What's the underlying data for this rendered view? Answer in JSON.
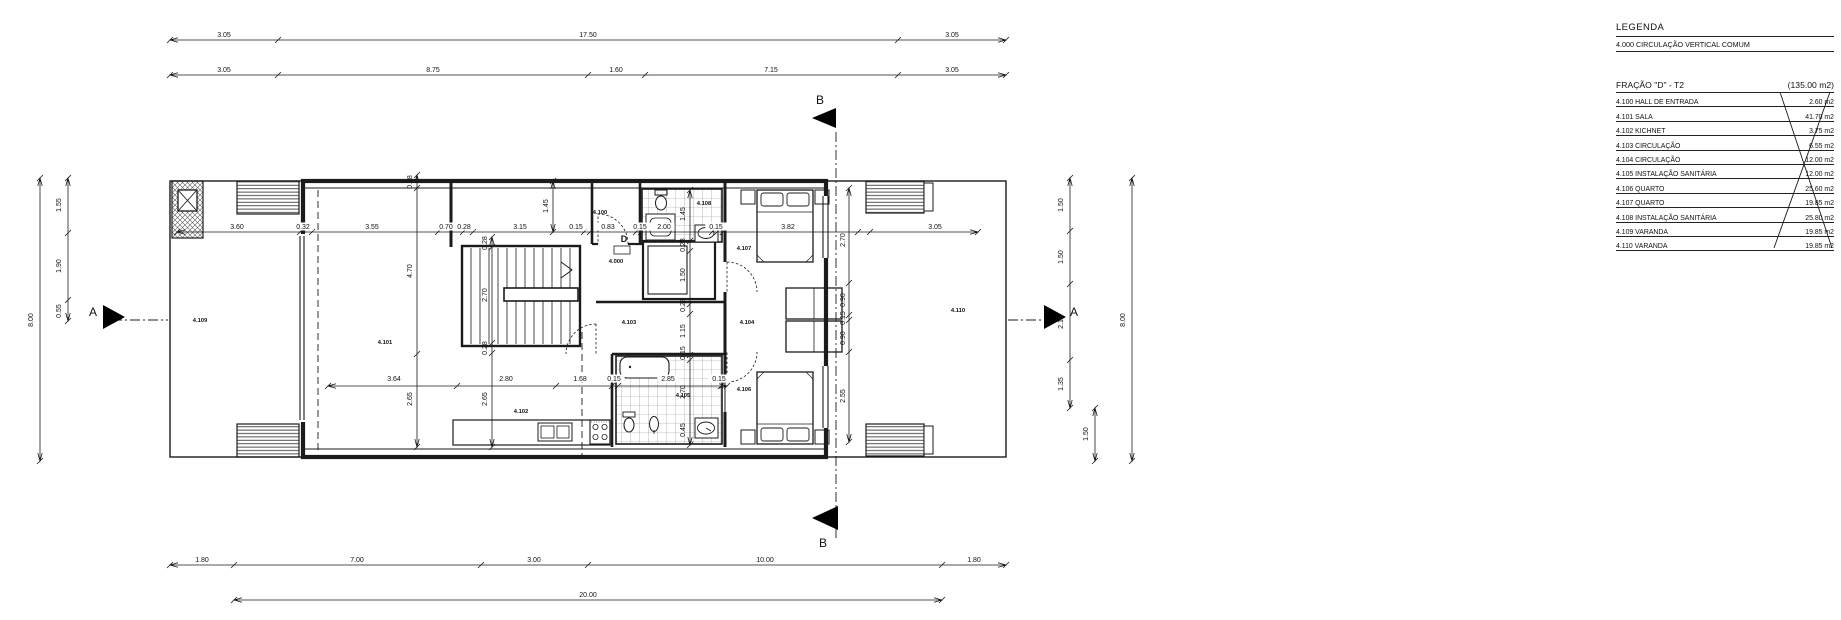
{
  "legend": {
    "title": "LEGENDA",
    "common_item": "4.000 CIRCULAÇÃO VERTICAL COMUM"
  },
  "fraction": {
    "title": "FRAÇÃO \"D\" - T2",
    "total_area": "(135.00 m2)",
    "rows": [
      {
        "code": "4.100",
        "name": "HALL DE ENTRADA",
        "area": "2.60 m2"
      },
      {
        "code": "4.101",
        "name": "SALA",
        "area": "41.70 m2"
      },
      {
        "code": "4.102",
        "name": "KICHNET",
        "area": "3.75 m2"
      },
      {
        "code": "4.103",
        "name": "CIRCULAÇÃO",
        "area": "6.55 m2"
      },
      {
        "code": "4.104",
        "name": "CIRCULAÇÃO",
        "area": "12.00 m2"
      },
      {
        "code": "4.105",
        "name": "INSTALAÇÃO SANITÁRIA",
        "area": "12.00 m2"
      },
      {
        "code": "4.106",
        "name": "QUARTO",
        "area": "25.60 m2"
      },
      {
        "code": "4.107",
        "name": "QUARTO",
        "area": "19.85 m2"
      },
      {
        "code": "4.108",
        "name": "INSTALAÇÃO SANITÁRIA",
        "area": "25.80 m2"
      },
      {
        "code": "4.109",
        "name": "VARANDA",
        "area": "19.85 m2"
      },
      {
        "code": "4.110",
        "name": "VARANDA",
        "area": "19.85 m2"
      }
    ],
    "crossed_out": true
  },
  "plan": {
    "line_color": "#1b1b1b",
    "annotations": [
      {
        "t": "3.05",
        "x": 224,
        "y": 37,
        "k": "d"
      },
      {
        "t": "17.50",
        "x": 588,
        "y": 37,
        "k": "d"
      },
      {
        "t": "3.05",
        "x": 952,
        "y": 37,
        "k": "d"
      },
      {
        "t": "3.05",
        "x": 224,
        "y": 72,
        "k": "d"
      },
      {
        "t": "8.75",
        "x": 433,
        "y": 72,
        "k": "d"
      },
      {
        "t": "1.60",
        "x": 616,
        "y": 72,
        "k": "d"
      },
      {
        "t": "7.15",
        "x": 771,
        "y": 72,
        "k": "d"
      },
      {
        "t": "3.05",
        "x": 952,
        "y": 72,
        "k": "d"
      },
      {
        "t": "1.80",
        "x": 202,
        "y": 562,
        "k": "d"
      },
      {
        "t": "7.00",
        "x": 357,
        "y": 562,
        "k": "d"
      },
      {
        "t": "3.00",
        "x": 534,
        "y": 562,
        "k": "d"
      },
      {
        "t": "10.00",
        "x": 765,
        "y": 562,
        "k": "d"
      },
      {
        "t": "1.80",
        "x": 974,
        "y": 562,
        "k": "d"
      },
      {
        "t": "20.00",
        "x": 588,
        "y": 597,
        "k": "d"
      },
      {
        "t": "8.00",
        "x": 33,
        "y": 320,
        "r": -90,
        "k": "d"
      },
      {
        "t": "1.55",
        "x": 61,
        "y": 205,
        "r": -90,
        "k": "d"
      },
      {
        "t": "1.90",
        "x": 61,
        "y": 266,
        "r": -90,
        "k": "d"
      },
      {
        "t": "0.55",
        "x": 61,
        "y": 311,
        "r": -90,
        "k": "d"
      },
      {
        "t": "1.50",
        "x": 1063,
        "y": 205,
        "r": -90,
        "k": "d"
      },
      {
        "t": "1.50",
        "x": 1063,
        "y": 257,
        "r": -90,
        "k": "d"
      },
      {
        "t": "2.15",
        "x": 1063,
        "y": 322,
        "r": -90,
        "k": "d"
      },
      {
        "t": "1.35",
        "x": 1063,
        "y": 384,
        "r": -90,
        "k": "d"
      },
      {
        "t": "1.50",
        "x": 1088,
        "y": 434,
        "r": -90,
        "k": "d"
      },
      {
        "t": "8.00",
        "x": 1125,
        "y": 320,
        "r": -90,
        "k": "d"
      },
      {
        "t": "3.60",
        "x": 237,
        "y": 229,
        "k": "d"
      },
      {
        "t": "0.32",
        "x": 303,
        "y": 229,
        "k": "d"
      },
      {
        "t": "3.55",
        "x": 372,
        "y": 229,
        "k": "d"
      },
      {
        "t": "0.70",
        "x": 446,
        "y": 229,
        "k": "d"
      },
      {
        "t": "0.28",
        "x": 464,
        "y": 229,
        "k": "d"
      },
      {
        "t": "3.15",
        "x": 520,
        "y": 229,
        "k": "d"
      },
      {
        "t": "0.15",
        "x": 576,
        "y": 229,
        "k": "d"
      },
      {
        "t": "0.83",
        "x": 608,
        "y": 229,
        "k": "d"
      },
      {
        "t": "0.15",
        "x": 640,
        "y": 229,
        "k": "d"
      },
      {
        "t": "2.00",
        "x": 664,
        "y": 229,
        "k": "d"
      },
      {
        "t": "0.15",
        "x": 716,
        "y": 229,
        "k": "d"
      },
      {
        "t": "3.82",
        "x": 788,
        "y": 229,
        "k": "d"
      },
      {
        "t": "3.05",
        "x": 935,
        "y": 229,
        "k": "d"
      },
      {
        "t": "3.64",
        "x": 394,
        "y": 381,
        "k": "d"
      },
      {
        "t": "2.80",
        "x": 506,
        "y": 381,
        "k": "d"
      },
      {
        "t": "1.68",
        "x": 580,
        "y": 381,
        "k": "d"
      },
      {
        "t": "0.15",
        "x": 614,
        "y": 381,
        "k": "d"
      },
      {
        "t": "2.85",
        "x": 668,
        "y": 381,
        "k": "d"
      },
      {
        "t": "0.15",
        "x": 719,
        "y": 381,
        "k": "d"
      },
      {
        "t": "0.28",
        "x": 412,
        "y": 182,
        "r": -90,
        "k": "d"
      },
      {
        "t": "4.70",
        "x": 412,
        "y": 271,
        "r": -90,
        "k": "d"
      },
      {
        "t": "2.65",
        "x": 412,
        "y": 399,
        "r": -90,
        "k": "d"
      },
      {
        "t": "0.28",
        "x": 487,
        "y": 243,
        "r": -90,
        "k": "d"
      },
      {
        "t": "2.70",
        "x": 487,
        "y": 295,
        "r": -90,
        "k": "d"
      },
      {
        "t": "0.28",
        "x": 487,
        "y": 348,
        "r": -90,
        "k": "d"
      },
      {
        "t": "2.65",
        "x": 487,
        "y": 399,
        "r": -90,
        "k": "d"
      },
      {
        "t": "1.45",
        "x": 548,
        "y": 206,
        "r": -90,
        "k": "d"
      },
      {
        "t": "1.45",
        "x": 685,
        "y": 214,
        "r": -90,
        "k": "d"
      },
      {
        "t": "0.28",
        "x": 685,
        "y": 245,
        "r": -90,
        "k": "d"
      },
      {
        "t": "1.50",
        "x": 685,
        "y": 275,
        "r": -90,
        "k": "d"
      },
      {
        "t": "0.28",
        "x": 685,
        "y": 305,
        "r": -90,
        "k": "d"
      },
      {
        "t": "1.15",
        "x": 685,
        "y": 331,
        "r": -90,
        "k": "d"
      },
      {
        "t": "0.15",
        "x": 685,
        "y": 353,
        "r": -90,
        "k": "d"
      },
      {
        "t": "2.70",
        "x": 685,
        "y": 392,
        "r": -90,
        "k": "d"
      },
      {
        "t": "0.45",
        "x": 685,
        "y": 430,
        "r": -90,
        "k": "d"
      },
      {
        "t": "2.70",
        "x": 845,
        "y": 240,
        "r": -90,
        "k": "d"
      },
      {
        "t": "0.90",
        "x": 845,
        "y": 300,
        "r": -90,
        "k": "d"
      },
      {
        "t": "0.15",
        "x": 845,
        "y": 318,
        "r": -90,
        "k": "d"
      },
      {
        "t": "0.90",
        "x": 845,
        "y": 338,
        "r": -90,
        "k": "d"
      },
      {
        "t": "2.55",
        "x": 845,
        "y": 396,
        "r": -90,
        "k": "d"
      },
      {
        "t": "4.109",
        "x": 200,
        "y": 322,
        "k": "r"
      },
      {
        "t": "4.101",
        "x": 385,
        "y": 344,
        "k": "r"
      },
      {
        "t": "4.102",
        "x": 521,
        "y": 413,
        "k": "r"
      },
      {
        "t": "4.100",
        "x": 600,
        "y": 214,
        "k": "r"
      },
      {
        "t": "4.000",
        "x": 616,
        "y": 263,
        "k": "r"
      },
      {
        "t": "4.103",
        "x": 629,
        "y": 324,
        "k": "r"
      },
      {
        "t": "4.108",
        "x": 704,
        "y": 205,
        "k": "r"
      },
      {
        "t": "4.107",
        "x": 744,
        "y": 250,
        "k": "r"
      },
      {
        "t": "4.104",
        "x": 747,
        "y": 324,
        "k": "r"
      },
      {
        "t": "4.105",
        "x": 683,
        "y": 397,
        "k": "r"
      },
      {
        "t": "4.106",
        "x": 744,
        "y": 391,
        "k": "r"
      },
      {
        "t": "4.110",
        "x": 958,
        "y": 312,
        "k": "r"
      },
      {
        "t": "A",
        "x": 93,
        "y": 316,
        "k": "m"
      },
      {
        "t": "A",
        "x": 1074,
        "y": 316,
        "k": "m"
      },
      {
        "t": "B",
        "x": 820,
        "y": 104,
        "k": "m"
      },
      {
        "t": "B",
        "x": 823,
        "y": 547,
        "k": "m"
      },
      {
        "t": "D",
        "x": 624,
        "y": 242,
        "k": "md"
      }
    ]
  }
}
